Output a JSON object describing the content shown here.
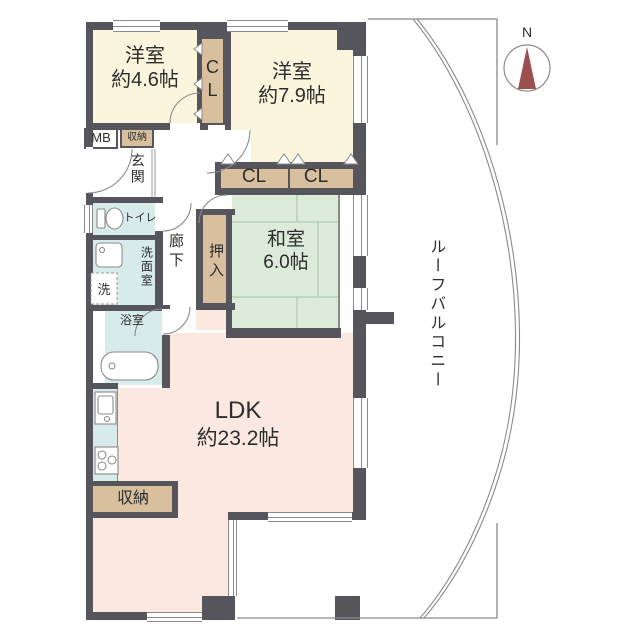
{
  "compass_label": "N",
  "balcony_label": "ルーフバルコニー",
  "rooms": {
    "western_small": {
      "name": "洋室",
      "size": "約4.6帖"
    },
    "western_large": {
      "name": "洋室",
      "size": "約7.9帖"
    },
    "japanese": {
      "name": "和室",
      "size": "6.0帖"
    },
    "ldk": {
      "name": "LDK",
      "size": "約23.2帖"
    }
  },
  "labels": {
    "closet_c": "C",
    "closet_l": "L",
    "closet_a": "CL",
    "closet_b": "CL",
    "oshiire": "押入",
    "hallway": "廊下",
    "entrance": "玄関",
    "meter_box": "MB",
    "storage_entrance": "収納",
    "toilet": "トイレ",
    "washroom": "洗面室",
    "washer": "洗",
    "bathroom": "浴室",
    "storage_ldk": "収納"
  },
  "colors": {
    "wall": "#57555c",
    "western_room": "#faf5dc",
    "closet": "#d8bf9e",
    "japanese_room": "#dcead9",
    "wet_area": "#d7ebea",
    "ldk": "#fbe8e0",
    "compass_needle": "#9c4f4f"
  }
}
